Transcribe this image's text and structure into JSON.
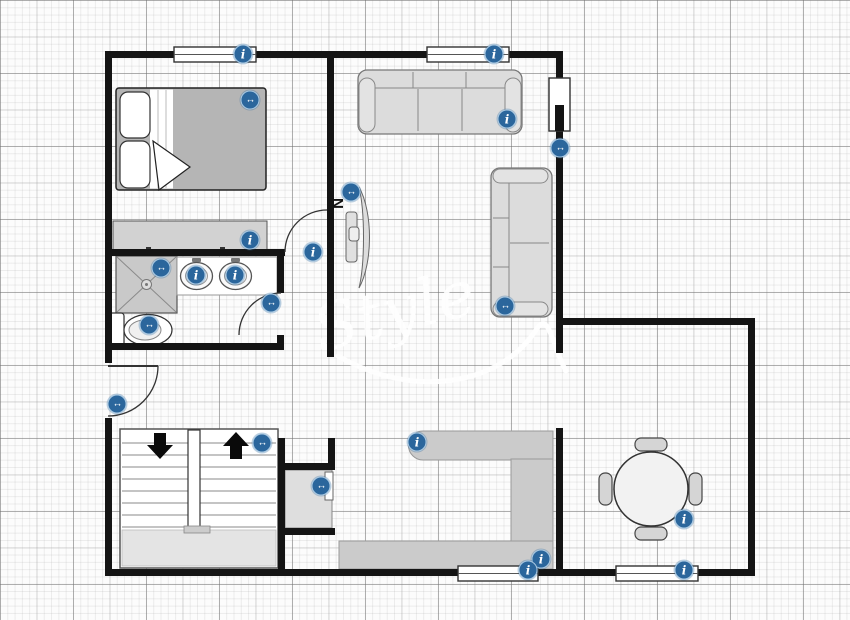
{
  "canvas": {
    "width": 850,
    "height": 620,
    "wall_color": "#141414",
    "grid_paper": true,
    "tag_color": "#2b669c",
    "tag_ring_color": "#aac9e2",
    "furniture_fill": "#dcdcdc",
    "counter_fill": "#cbcbcb"
  },
  "watermark": {
    "text": "Style"
  },
  "compass": {
    "label": "N"
  },
  "elements": {
    "rooms": [
      "bedroom",
      "bathroom",
      "living-room",
      "hallway-stairwell",
      "kitchen",
      "dining-room"
    ],
    "furniture": [
      "double-bed",
      "dresser",
      "shower",
      "double-sink-vanity",
      "toilet",
      "three-seat-sofa",
      "loveseat",
      "wall-tv",
      "sliding-window",
      "u-shaped-staircase",
      "closet",
      "kitchen-counter",
      "round-dining-table",
      "four-chairs"
    ],
    "windows": [
      "bedroom-window",
      "living-window",
      "kitchen-window",
      "dining-window"
    ],
    "doors": [
      "bedroom-door",
      "bathroom-door",
      "entry-door"
    ]
  },
  "icons": [
    {
      "name": "bedroom-window-tag",
      "type": "info",
      "glyph": "i",
      "x": 243,
      "y": 54
    },
    {
      "name": "bed-tag",
      "type": "move",
      "glyph": "↔",
      "x": 250,
      "y": 100
    },
    {
      "name": "living-window-tag",
      "type": "info",
      "glyph": "i",
      "x": 494,
      "y": 54
    },
    {
      "name": "sofa-tag",
      "type": "info",
      "glyph": "i",
      "x": 507,
      "y": 119
    },
    {
      "name": "sliding-window-tag",
      "type": "move",
      "glyph": "↔",
      "x": 560,
      "y": 148
    },
    {
      "name": "tv-tag",
      "type": "move",
      "glyph": "↔",
      "x": 351,
      "y": 192
    },
    {
      "name": "loveseat-tag",
      "type": "move",
      "glyph": "↔",
      "x": 505,
      "y": 306
    },
    {
      "name": "dresser-tag",
      "type": "info",
      "glyph": "i",
      "x": 250,
      "y": 240
    },
    {
      "name": "bedroom-door-tag",
      "type": "info",
      "glyph": "i",
      "x": 313,
      "y": 252
    },
    {
      "name": "shower-tag",
      "type": "move",
      "glyph": "↔",
      "x": 161,
      "y": 268
    },
    {
      "name": "sink-left-tag",
      "type": "info",
      "glyph": "i",
      "x": 196,
      "y": 275
    },
    {
      "name": "sink-right-tag",
      "type": "info",
      "glyph": "i",
      "x": 235,
      "y": 275
    },
    {
      "name": "toilet-tag",
      "type": "move",
      "glyph": "↔",
      "x": 149,
      "y": 325
    },
    {
      "name": "bathroom-door-tag",
      "type": "move",
      "glyph": "↔",
      "x": 271,
      "y": 303
    },
    {
      "name": "entry-door-tag",
      "type": "move",
      "glyph": "↔",
      "x": 117,
      "y": 404
    },
    {
      "name": "stairs-tag",
      "type": "move",
      "glyph": "↔",
      "x": 262,
      "y": 443
    },
    {
      "name": "closet-tag",
      "type": "move",
      "glyph": "↔",
      "x": 321,
      "y": 486
    },
    {
      "name": "counter-end-tag",
      "type": "info",
      "glyph": "i",
      "x": 417,
      "y": 442
    },
    {
      "name": "counter-corner-tag",
      "type": "info",
      "glyph": "i",
      "x": 541,
      "y": 559
    },
    {
      "name": "kitchen-window-tag",
      "type": "info",
      "glyph": "i",
      "x": 528,
      "y": 570
    },
    {
      "name": "dining-table-tag",
      "type": "info",
      "glyph": "i",
      "x": 684,
      "y": 519
    },
    {
      "name": "dining-window-tag",
      "type": "info",
      "glyph": "i",
      "x": 684,
      "y": 570
    }
  ]
}
